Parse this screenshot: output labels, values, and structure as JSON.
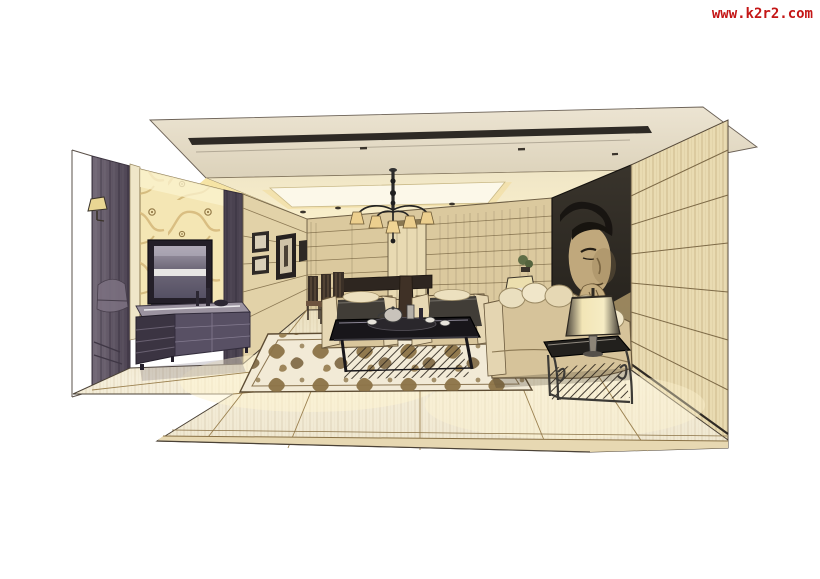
{
  "page": {
    "width": 820,
    "height": 579,
    "background": "#ffffff"
  },
  "watermark": {
    "text": "www.k2r2.com",
    "color": "#c41616"
  },
  "scene": {
    "kind": "hand-drawn interior design marker rendering",
    "subject": "modern living room drawn in one-point perspective on white paper",
    "elements": [
      "floating ceiling slab with dark recessed light slot",
      "tray ceiling with warm cove lighting and luminous panel",
      "six-arm chandelier with small fabric shades",
      "gold floral wallpaper feature wall with wall-mounted TV",
      "long dark media cabinet with decor objects",
      "dark aubergine wall panels and pillar",
      "wall sconce",
      "gallery of small picture frames",
      "banded beige stone back wall with tall center panel",
      "large dark mural of a woman's face on angled wall",
      "beige wood plank right wall",
      "cream sofa with row of pillows",
      "two cream armchairs with charcoal cushions",
      "dark coffee table with silver tea set",
      "patterned damask area rug",
      "ornate wrought-metal side table with shaded table lamp",
      "small console with lamp and green plant",
      "dark dining chairs with slatted backs",
      "polished cream marble floor fading to white paper"
    ],
    "palette": {
      "paper": "#ffffff",
      "ink": "#463d31",
      "ceiling_slab": "#e7dfcd",
      "cove_glow": "#f6e4a4",
      "wall_beige": "#dbc99e",
      "wallpaper_gold": "#f4e6b4",
      "panel_aubergine": "#5d5462",
      "mural_dark": "#2a2621",
      "mural_skin": "#c0a87c",
      "sofa_tan": "#d6c39a",
      "cushion_charcoal": "#413d37",
      "floor_cream": "#f3ead2",
      "rug_brown": "#8c7347",
      "watermark_red": "#c41616"
    }
  }
}
